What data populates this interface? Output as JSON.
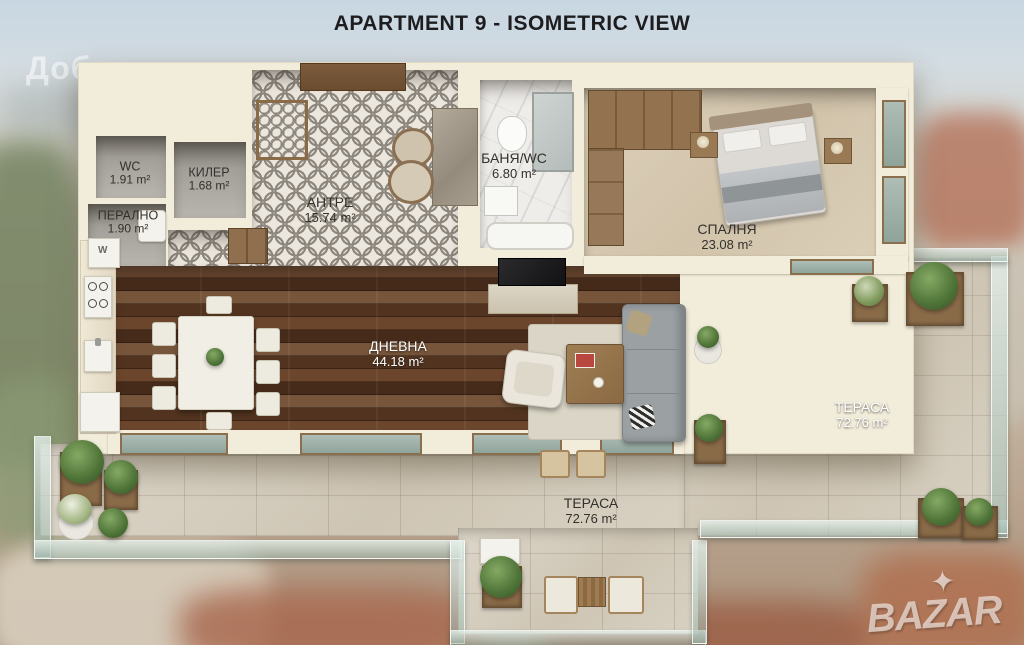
{
  "title": "APARTMENT 9 - ISOMETRIC VIEW",
  "watermarks": {
    "top_left": "Добрев",
    "bottom_right": "BAZAR",
    "logo_star": "✦"
  },
  "rooms": [
    {
      "id": "wc",
      "name": "WC",
      "area": "1.91 m²"
    },
    {
      "id": "kiler",
      "name": "КИЛЕР",
      "area": "1.68 m²"
    },
    {
      "id": "peralno",
      "name": "ПЕРАЛНО",
      "area": "1.90 m²"
    },
    {
      "id": "antre",
      "name": "АНТРЕ",
      "area": "15.74 m²"
    },
    {
      "id": "banya-wc",
      "name": "БАНЯ/WC",
      "area": "6.80 m²"
    },
    {
      "id": "spalnya",
      "name": "СПАЛНЯ",
      "area": "23.08 m²"
    },
    {
      "id": "dnevna",
      "name": "ДНЕВНА",
      "area": "44.18 m²"
    },
    {
      "id": "terasa-right",
      "name": "ТЕРАСА",
      "area": "72.76 m²"
    },
    {
      "id": "terasa-bottom",
      "name": "ТЕРАСА",
      "area": "72.76 m²"
    }
  ],
  "labels": {
    "washer": "W"
  },
  "colors": {
    "wall_cream": "#f2ecda",
    "wood_floor": "#5f3e27",
    "stone_terrace": "#d5cec0",
    "hall_tile_grey": "#8d867c",
    "glass_railing": "#9bb5aa",
    "plant_green": "#4e7337",
    "planter_brown": "#8a6b48",
    "sofa_grey": "#9ba1a3",
    "title_text": "#1d1d1f"
  }
}
